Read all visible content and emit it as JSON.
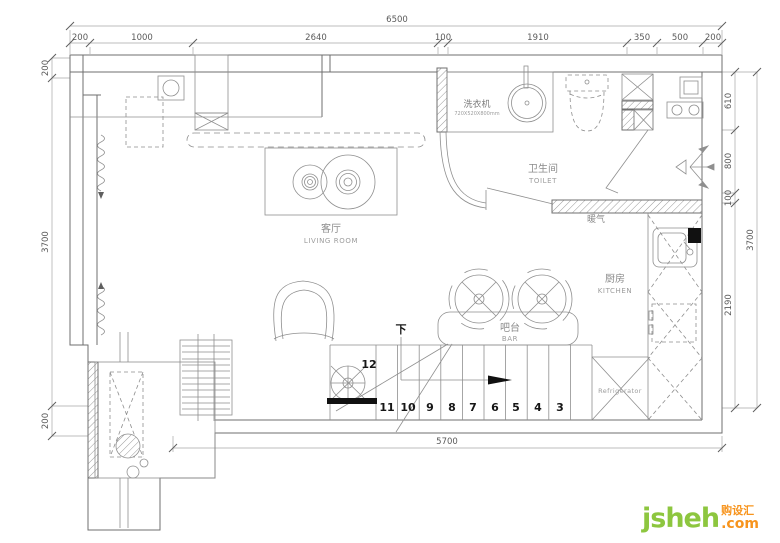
{
  "dims": {
    "top_total": "6500",
    "top": [
      "200",
      "1000",
      "2640",
      "100",
      "1910",
      "350",
      "500",
      "200"
    ],
    "left": [
      "200",
      "3700",
      "200"
    ],
    "right": [
      "610",
      "800",
      "100",
      "2190"
    ],
    "right_total": "3700",
    "bottom": "5700"
  },
  "labels": {
    "washer_zh": "洗衣机",
    "washer_size": "720X520X800mm",
    "toilet_zh": "卫生间",
    "toilet_en": "TOILET",
    "living_zh": "客厅",
    "living_en": "LIVING ROOM",
    "kitchen_zh": "厨房",
    "kitchen_en": "KITCHEN",
    "bar_zh": "吧台",
    "bar_en": "BAR",
    "heater_zh": "暖气",
    "fridge_en": "Refrigerator",
    "down_zh": "下",
    "steps": [
      "12",
      "11",
      "10",
      "9",
      "8",
      "7",
      "6",
      "5",
      "4",
      "3"
    ]
  },
  "watermark": {
    "brand": "jsheh",
    "cn": "购设汇",
    "tld": ".com"
  },
  "colors": {
    "line": "#6f6f6f",
    "dim": "#a8a8a8",
    "logo_green": "#8dc63f",
    "logo_orange": "#f7941d"
  }
}
